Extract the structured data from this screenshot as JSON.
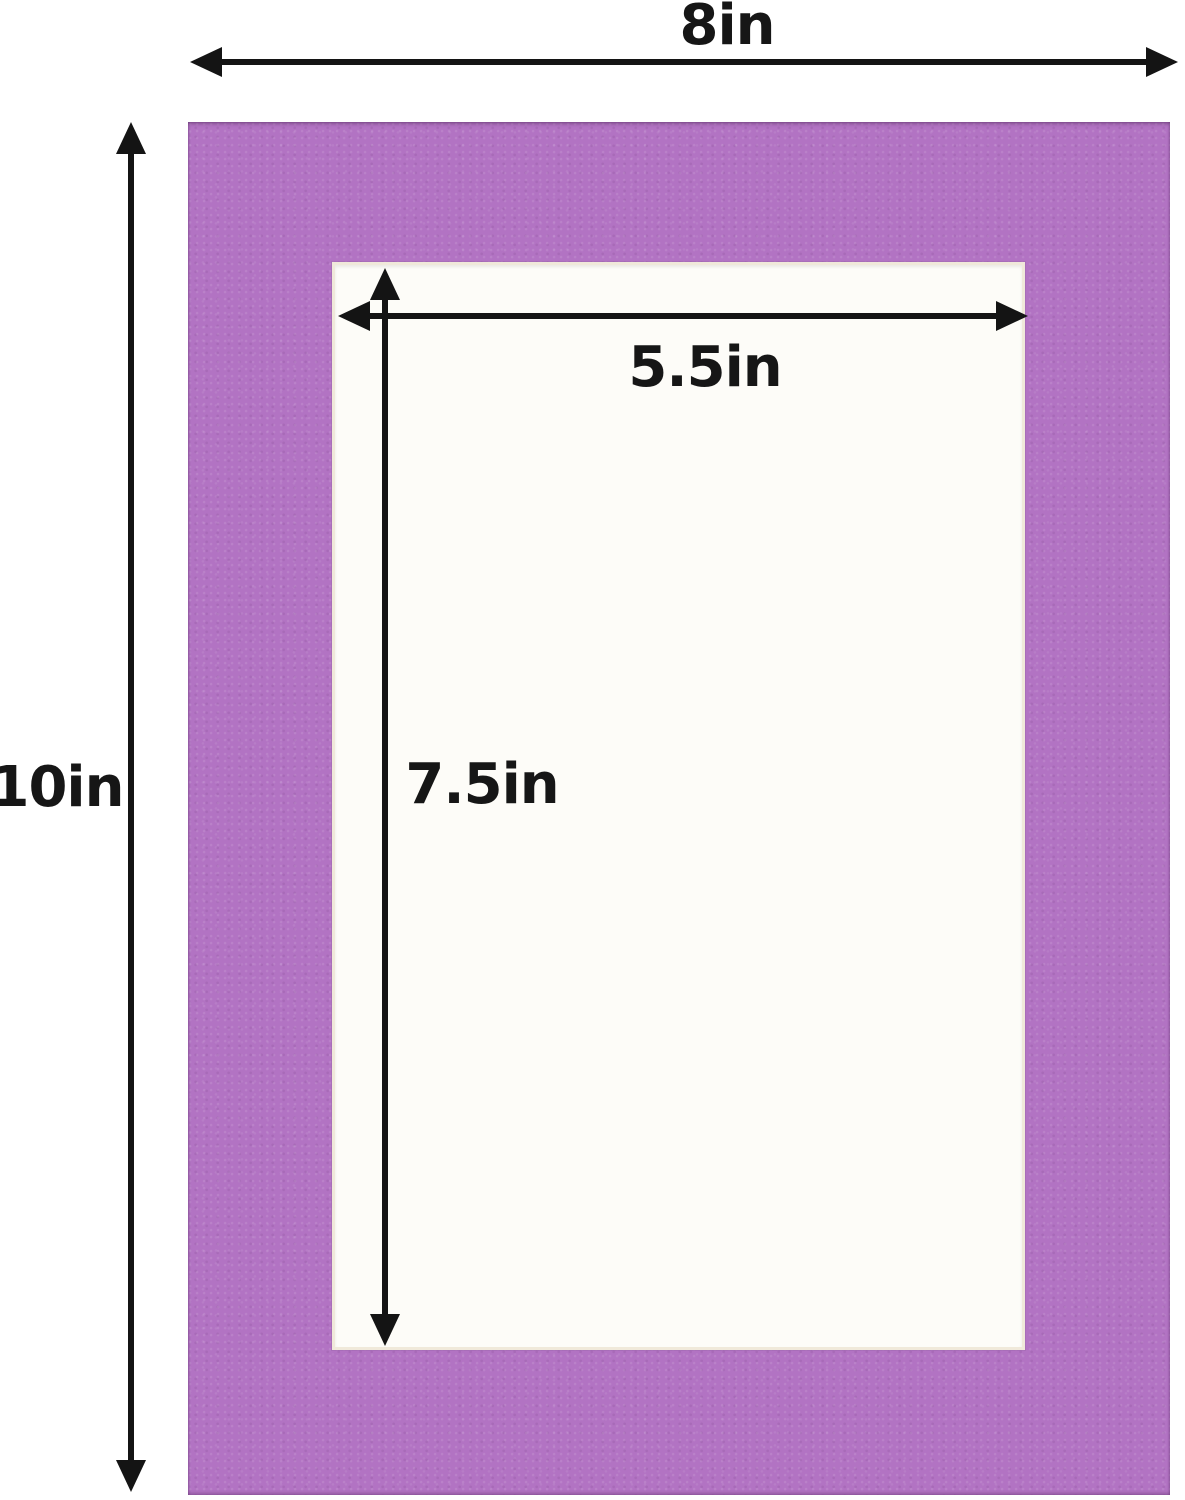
{
  "diagram": {
    "type": "picture-mat-dimension-diagram",
    "labels": {
      "outer_width": "8in",
      "outer_height": "10in",
      "opening_width": "5.5in",
      "opening_height": "7.5in"
    },
    "colors": {
      "mat_purple": "#b273c3",
      "opening_fill": "#fdfcf8",
      "opening_bevel": "#f0e9da",
      "arrow_black": "#141414",
      "background": "#ffffff"
    }
  }
}
